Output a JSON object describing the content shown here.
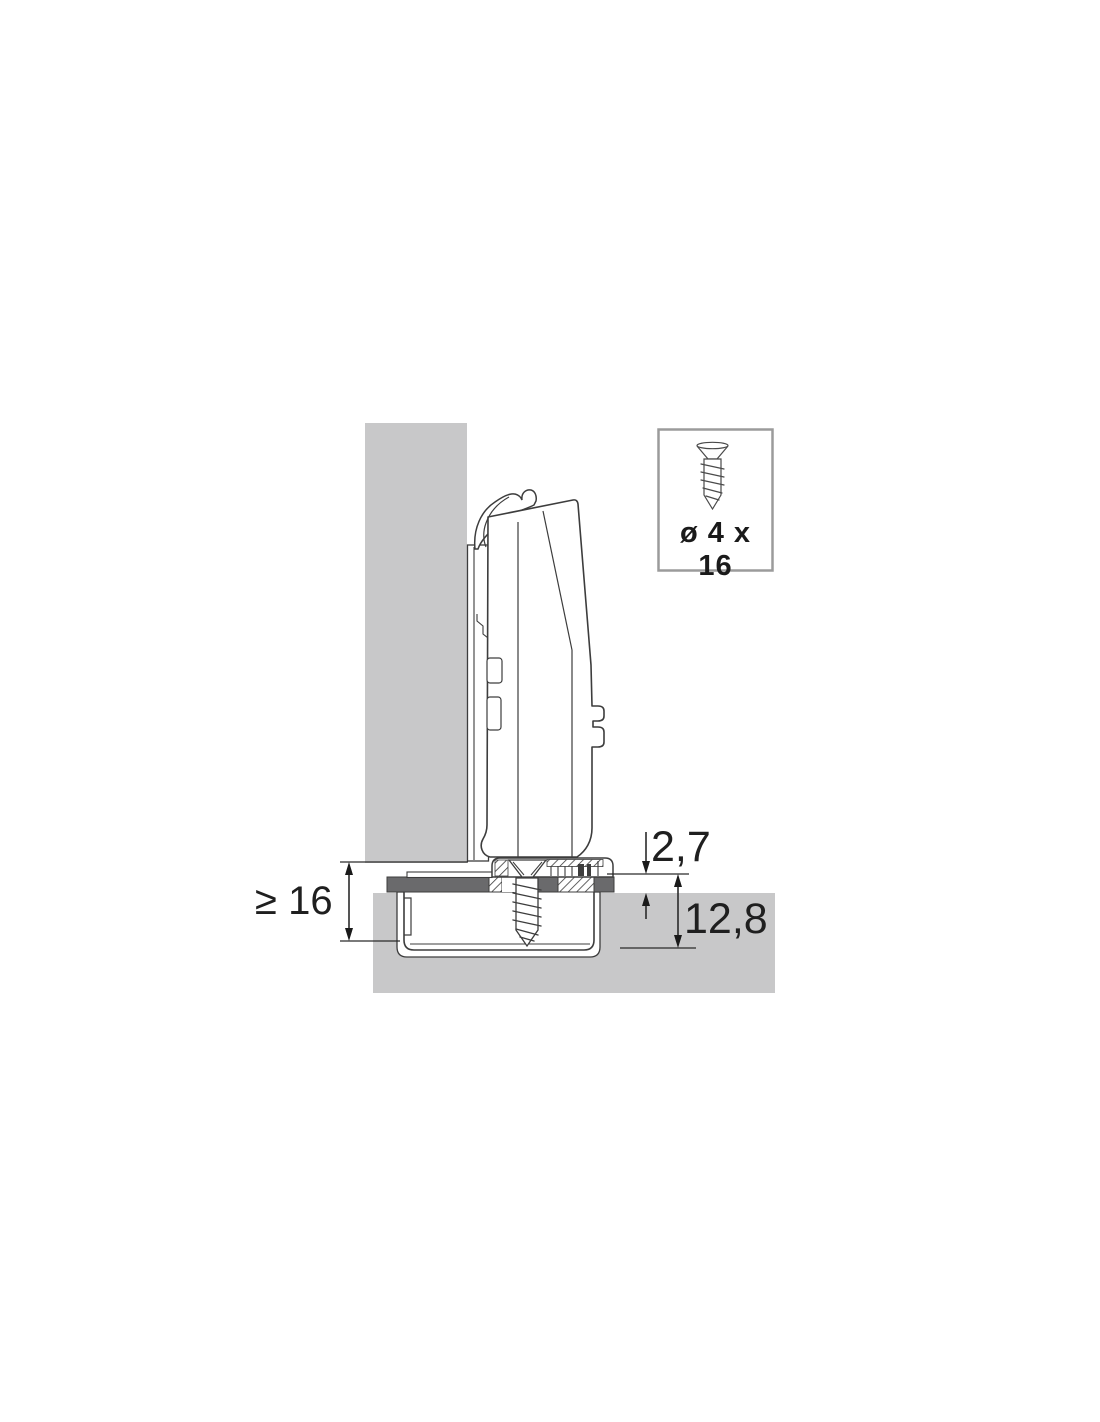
{
  "labels": {
    "flange_offset": "2,7",
    "cup_depth": "12,8",
    "min_thickness": "≥ 16",
    "screw_spec": "ø 4 x 16"
  },
  "icons": {
    "screw_callout": "countersunk-screw-icon"
  },
  "colors": {
    "panel_gray": "#c8c8c9",
    "flange_gray": "#6a6a6c",
    "line": "#3d3d3d",
    "text": "#1f1f1f",
    "callout_border": "#9b9b9b",
    "background": "#ffffff"
  }
}
